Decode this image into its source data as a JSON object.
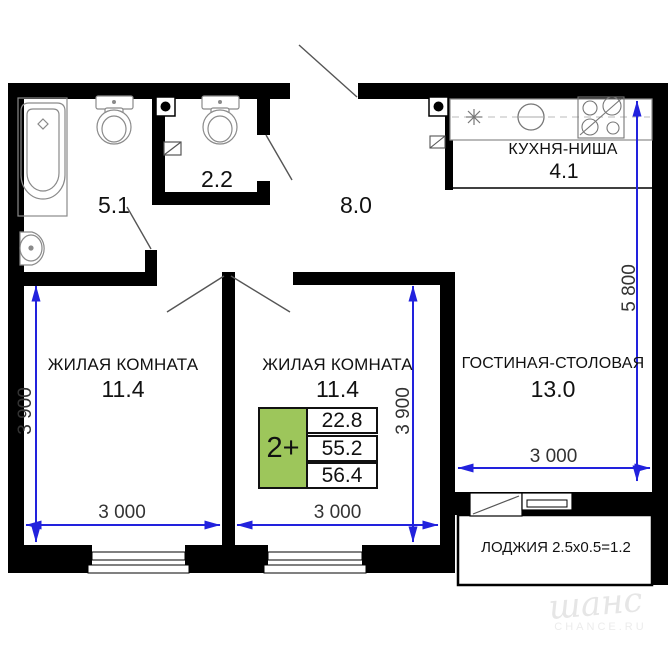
{
  "rooms": {
    "living1": {
      "label": "ЖИЛАЯ КОМНАТА",
      "area": "11.4"
    },
    "living2": {
      "label": "ЖИЛАЯ КОМНАТА",
      "area": "11.4"
    },
    "dining": {
      "label": "ГОСТИНАЯ-СТОЛОВАЯ",
      "area": "13.0"
    },
    "kitchen": {
      "label": "КУХНЯ-НИША",
      "area": "4.1"
    },
    "hall": {
      "area": "8.0"
    },
    "bathroom": {
      "area": "5.1"
    },
    "wc": {
      "area": "2.2"
    },
    "loggia": {
      "label": "ЛОДЖИЯ 2.5x0.5=1.2"
    }
  },
  "dimensions": {
    "living1_width": "3 000",
    "living1_height": "3 900",
    "living2_width": "3 000",
    "living2_height": "3 900",
    "dining_width": "3 000",
    "right_side_height": "5 800"
  },
  "badge": {
    "label": "2+",
    "rows": [
      "22.8",
      "55.2",
      "56.4"
    ]
  },
  "watermark": {
    "script": "шанс",
    "caption": "CHANCE.RU"
  },
  "colors": {
    "wall": "#000000",
    "dimension_blue": "#2222dd",
    "badge_green": "#9dc65b",
    "watermark_gray": "#e6e6e6"
  }
}
